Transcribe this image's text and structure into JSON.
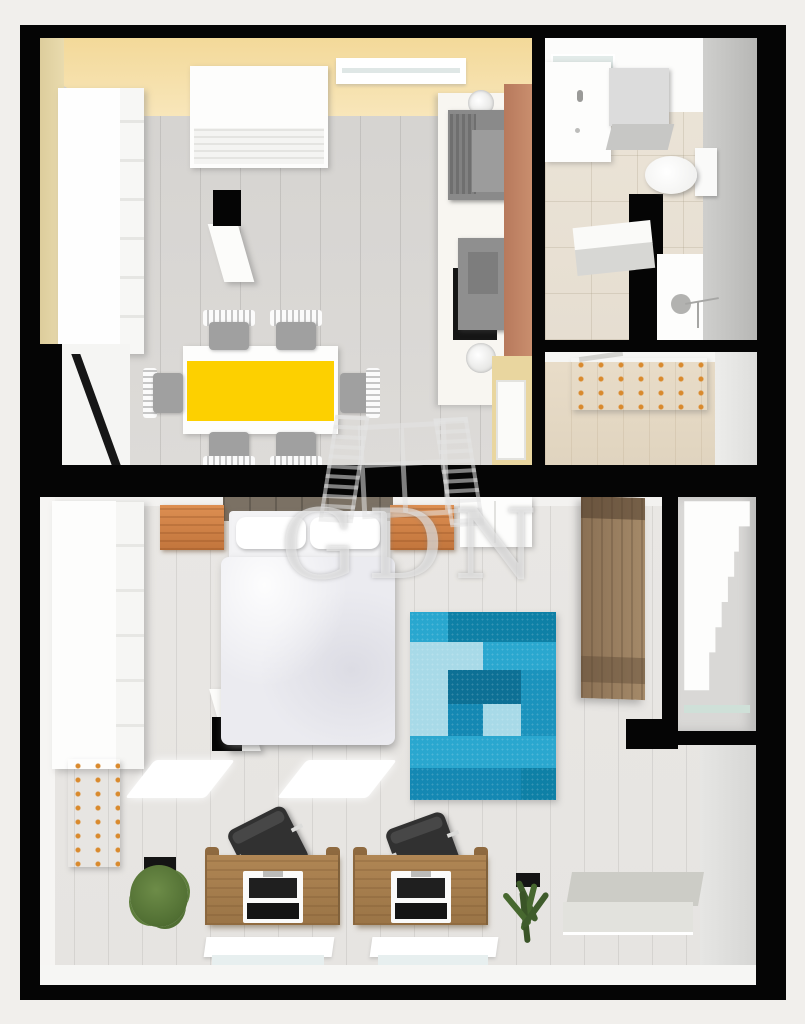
{
  "watermark": {
    "text": "GDN",
    "icon": "open-window-icon"
  },
  "palette": {
    "background": "#f1efec",
    "wall_black": "#050505",
    "wall_yellow": "#f6dfa8",
    "wall_tan": "#e4d5a5",
    "wall_terracotta": "#c2825f",
    "floor_upper_wood": "#d8d6d3",
    "floor_bathroom_tile": "#eae3d6",
    "floor_hall_wood": "#e3d7c3",
    "floor_lower_wood": "#e9e7e4",
    "table_runner_yellow": "#fdd000",
    "chair_seat_gray": "#a0a0a0",
    "appliance_gray": "#8f8f8f",
    "desk_wood": "#a57c4e",
    "nightstand_wood": "#cd7f43",
    "tall_wardrobe_wood": "#94795c",
    "plant_green": "#5d7d3b",
    "radiator_gray": "#d5d5d0",
    "rug_blues": [
      "#29a7cf",
      "#0e80a6",
      "#a8dae8",
      "#1488b3",
      "#0d7095",
      "#1b93bd"
    ]
  },
  "rug": {
    "rows": [
      [
        "#29a7cf",
        "#0e80a6",
        "#0e80a6",
        "#0e80a6"
      ],
      [
        "#a8dae8",
        "#a8dae8",
        "#2aa7cf",
        "#2aa7cf"
      ],
      [
        "#a8dae8",
        "#0d7095",
        "#0d7095",
        "#1b93bd"
      ],
      [
        "#a8dae8",
        "#1488b3",
        "#a8dae8",
        "#1b93bd"
      ],
      [
        "#2aa7cf",
        "#2aa7cf",
        "#2aa7cf",
        "#2aa7cf"
      ],
      [
        "#1488b3",
        "#1488b3",
        "#1488b3",
        "#0e80a6"
      ]
    ]
  },
  "floors": [
    {
      "name": "upper-floor",
      "rooms": [
        {
          "name": "kitchen-dining",
          "furniture": [
            "left-wardrobe",
            "sideboard",
            "north-window",
            "tv",
            "chimney",
            "dining-table-yellow-runner",
            "chair-x6",
            "kitchen-counter",
            "round-sink-x2",
            "stove",
            "appliance",
            "terracotta-accent-wall",
            "door"
          ]
        },
        {
          "name": "bathroom",
          "furniture": [
            "mirror",
            "vanity-sink",
            "washing-machine",
            "toilet",
            "partition-wall",
            "shower"
          ]
        },
        {
          "name": "hallway",
          "furniture": [
            "radiator"
          ]
        }
      ]
    },
    {
      "name": "lower-floor",
      "rooms": [
        {
          "name": "bedroom-studio",
          "furniture": [
            "left-wardrobe",
            "radiator-left",
            "plant-left",
            "double-bed",
            "nightstand-x2",
            "white-dresser",
            "chimney",
            "blue-patch-rug",
            "tall-brown-wardrobe",
            "staircase",
            "desk-x2",
            "office-chair-x2",
            "white-rug-x2",
            "window-x2",
            "plant-right",
            "radiator-right"
          ]
        }
      ]
    }
  ]
}
